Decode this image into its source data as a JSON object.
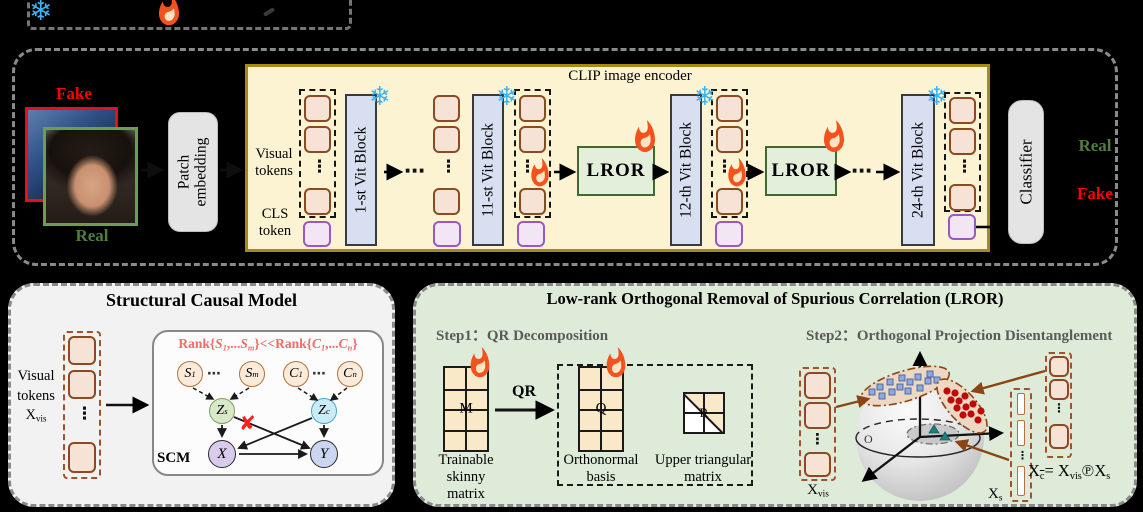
{
  "icons": {
    "snowflake": "❄",
    "vdots": "⋮",
    "hdots": "⋯",
    "cross": "✘"
  },
  "colors": {
    "snowflake": "#3FB3F0",
    "flame": "#F4511E",
    "fake": "#FF0000",
    "real": "#4E7E3A",
    "rank": "#F26B6B",
    "brown": "#8B4513",
    "encoder_bg": "#FCF3D2",
    "lror_bg": "#E3EFDA"
  },
  "top_panel": {
    "fake_label": "Fake",
    "real_label": "Real",
    "patch_embedding": {
      "line1": "Patch",
      "line2": "embedding"
    },
    "encoder": {
      "title": "CLIP image encoder",
      "visual_tokens": {
        "line1": "Visual",
        "line2": "tokens"
      },
      "cls_token": {
        "line1": "CLS",
        "line2": "token"
      },
      "blocks": [
        "1-st Vit Block",
        "11-st Vit Block",
        "12-th Vit Block",
        "24-th Vit Block"
      ],
      "lror": "LROR"
    },
    "classifier": "Classifier",
    "output_real": "Real",
    "output_fake": "Fake"
  },
  "scm_panel": {
    "title": "Structural Causal Model",
    "visual_tokens": {
      "line1": "Visual",
      "line2": "tokens"
    },
    "xvis": [
      {
        "v": "X"
      },
      {
        "v": "vis",
        "sub": 1
      }
    ],
    "rank_text": [
      {
        "v": "Rank{"
      },
      {
        "v": "S",
        "i": 1
      },
      {
        "v": "1",
        "i": 1,
        "sub": 1
      },
      {
        "v": ",..."
      },
      {
        "v": "S",
        "i": 1
      },
      {
        "v": "m",
        "i": 1,
        "sub": 1
      },
      {
        "v": "}<<Rank{"
      },
      {
        "v": "C",
        "i": 1
      },
      {
        "v": "1",
        "i": 1,
        "sub": 1
      },
      {
        "v": ",..."
      },
      {
        "v": "C",
        "i": 1
      },
      {
        "v": "n",
        "i": 1,
        "sub": 1
      },
      {
        "v": "}"
      }
    ],
    "nodes": {
      "s1": [
        {
          "v": "S",
          "i": 1
        },
        {
          "v": "1",
          "i": 1,
          "sub": 1
        }
      ],
      "sm": [
        {
          "v": "S",
          "i": 1
        },
        {
          "v": "m",
          "i": 1,
          "sub": 1
        }
      ],
      "c1": [
        {
          "v": "C",
          "i": 1
        },
        {
          "v": "1",
          "i": 1,
          "sub": 1
        }
      ],
      "cn": [
        {
          "v": "C",
          "i": 1
        },
        {
          "v": "n",
          "i": 1,
          "sub": 1
        }
      ],
      "zs": [
        {
          "v": "Z",
          "i": 1
        },
        {
          "v": "s",
          "i": 1,
          "sub": 1
        }
      ],
      "zc": [
        {
          "v": "Z",
          "i": 1
        },
        {
          "v": "c",
          "i": 1,
          "sub": 1
        }
      ],
      "x": [
        {
          "v": "X",
          "i": 1
        }
      ],
      "y": [
        {
          "v": "Y",
          "i": 1
        }
      ]
    },
    "scm_label": "SCM"
  },
  "lror_panel": {
    "title": "Low-rank Orthogonal Removal of Spurious Correlation (LROR)",
    "step1": {
      "label": "Step1：QR Decomposition",
      "m_letter": "M",
      "q_letter": "Q",
      "r_letter": "R",
      "qr_label": "QR",
      "m_caption": {
        "line1": "Trainable skinny",
        "line2": "matrix"
      },
      "q_caption": {
        "line1": "Orthonormal",
        "line2": "basis"
      },
      "r_caption": {
        "line1": "Upper triangular",
        "line2": "matrix"
      }
    },
    "step2": {
      "label": "Step2：Orthogonal Projection Disentanglement",
      "origin": "O",
      "xvis": [
        {
          "v": "X"
        },
        {
          "v": "vis",
          "sub": 1
        }
      ],
      "xs": [
        {
          "v": "X"
        },
        {
          "v": "s",
          "sub": 1
        }
      ],
      "formula": [
        {
          "v": "X"
        },
        {
          "v": "c",
          "sub": 1,
          "ov": 1
        },
        {
          "v": "= "
        },
        {
          "v": "X"
        },
        {
          "v": "vis",
          "sub": 1
        },
        {
          "v": "℗"
        },
        {
          "v": "X"
        },
        {
          "v": "s",
          "sub": 1
        }
      ]
    }
  }
}
